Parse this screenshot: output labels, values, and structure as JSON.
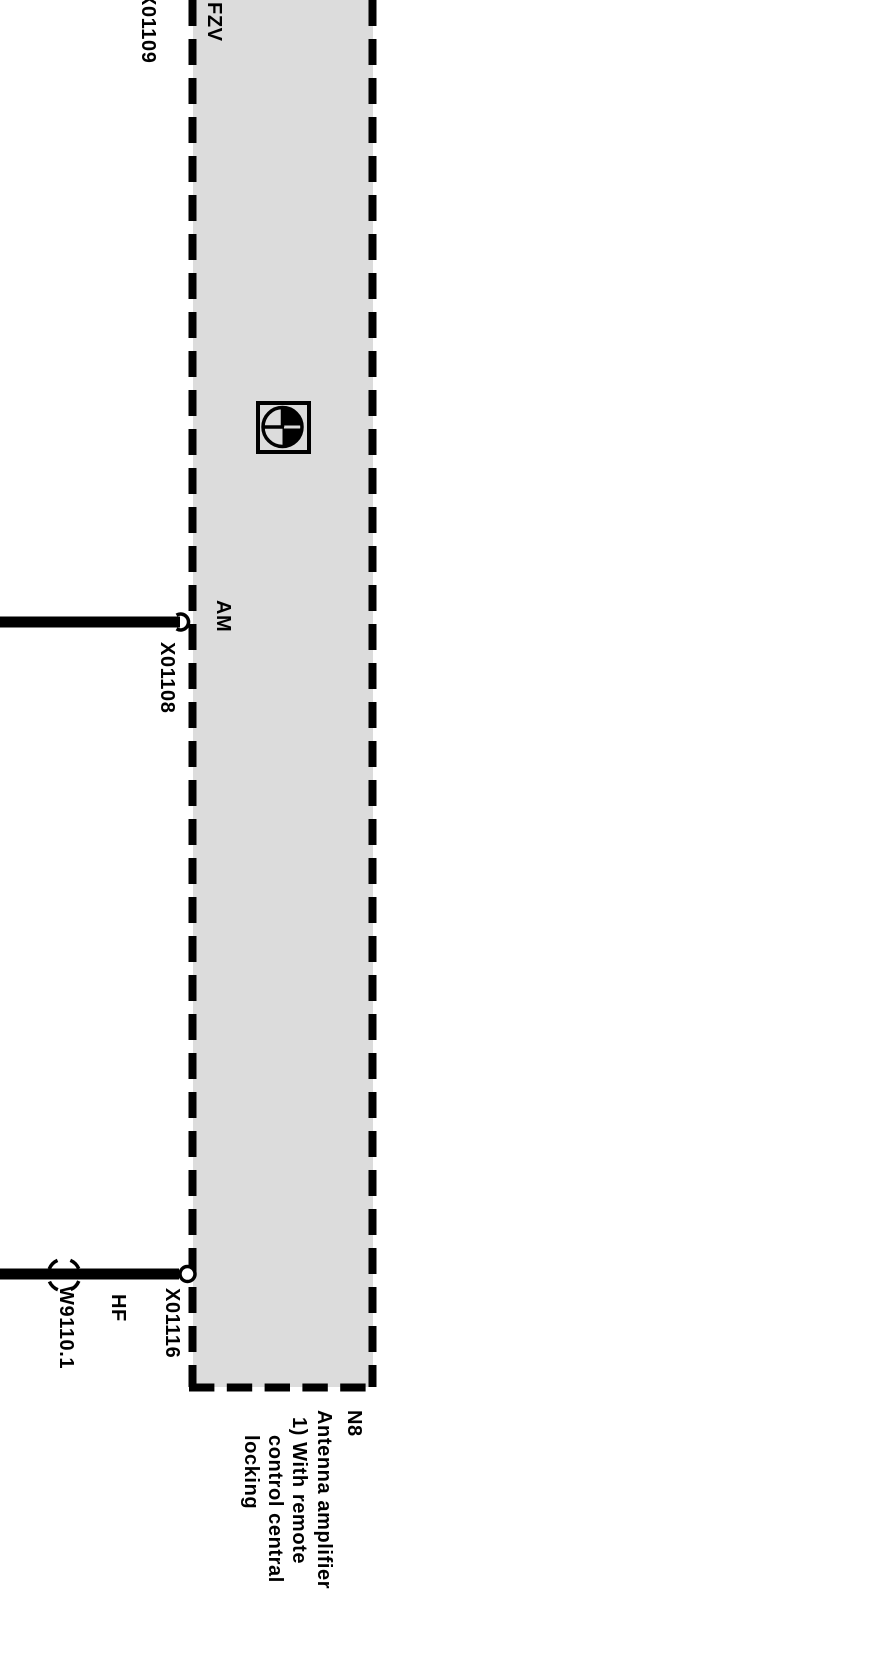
{
  "labels": {
    "fzv": "FZV",
    "am": "AM",
    "hf": "HF",
    "x01109": "X01109",
    "x01108": "X01108",
    "x01116": "X01116",
    "w9110_1": "W9110.1"
  },
  "legend": {
    "code": "N8",
    "name": "Antenna amplifier",
    "footnote": [
      "1) With remote",
      "control central",
      "locking"
    ]
  },
  "icons": {
    "component_symbol": "pie-clock-component-icon",
    "connector_socket": "half-circle-socket-icon",
    "connector_ring": "open-circle-connector-icon",
    "shield_marker": "dashed-circle-shield-icon"
  },
  "colors": {
    "box_fill": "#dcdcdc",
    "line": "#000000",
    "background": "#ffffff"
  }
}
